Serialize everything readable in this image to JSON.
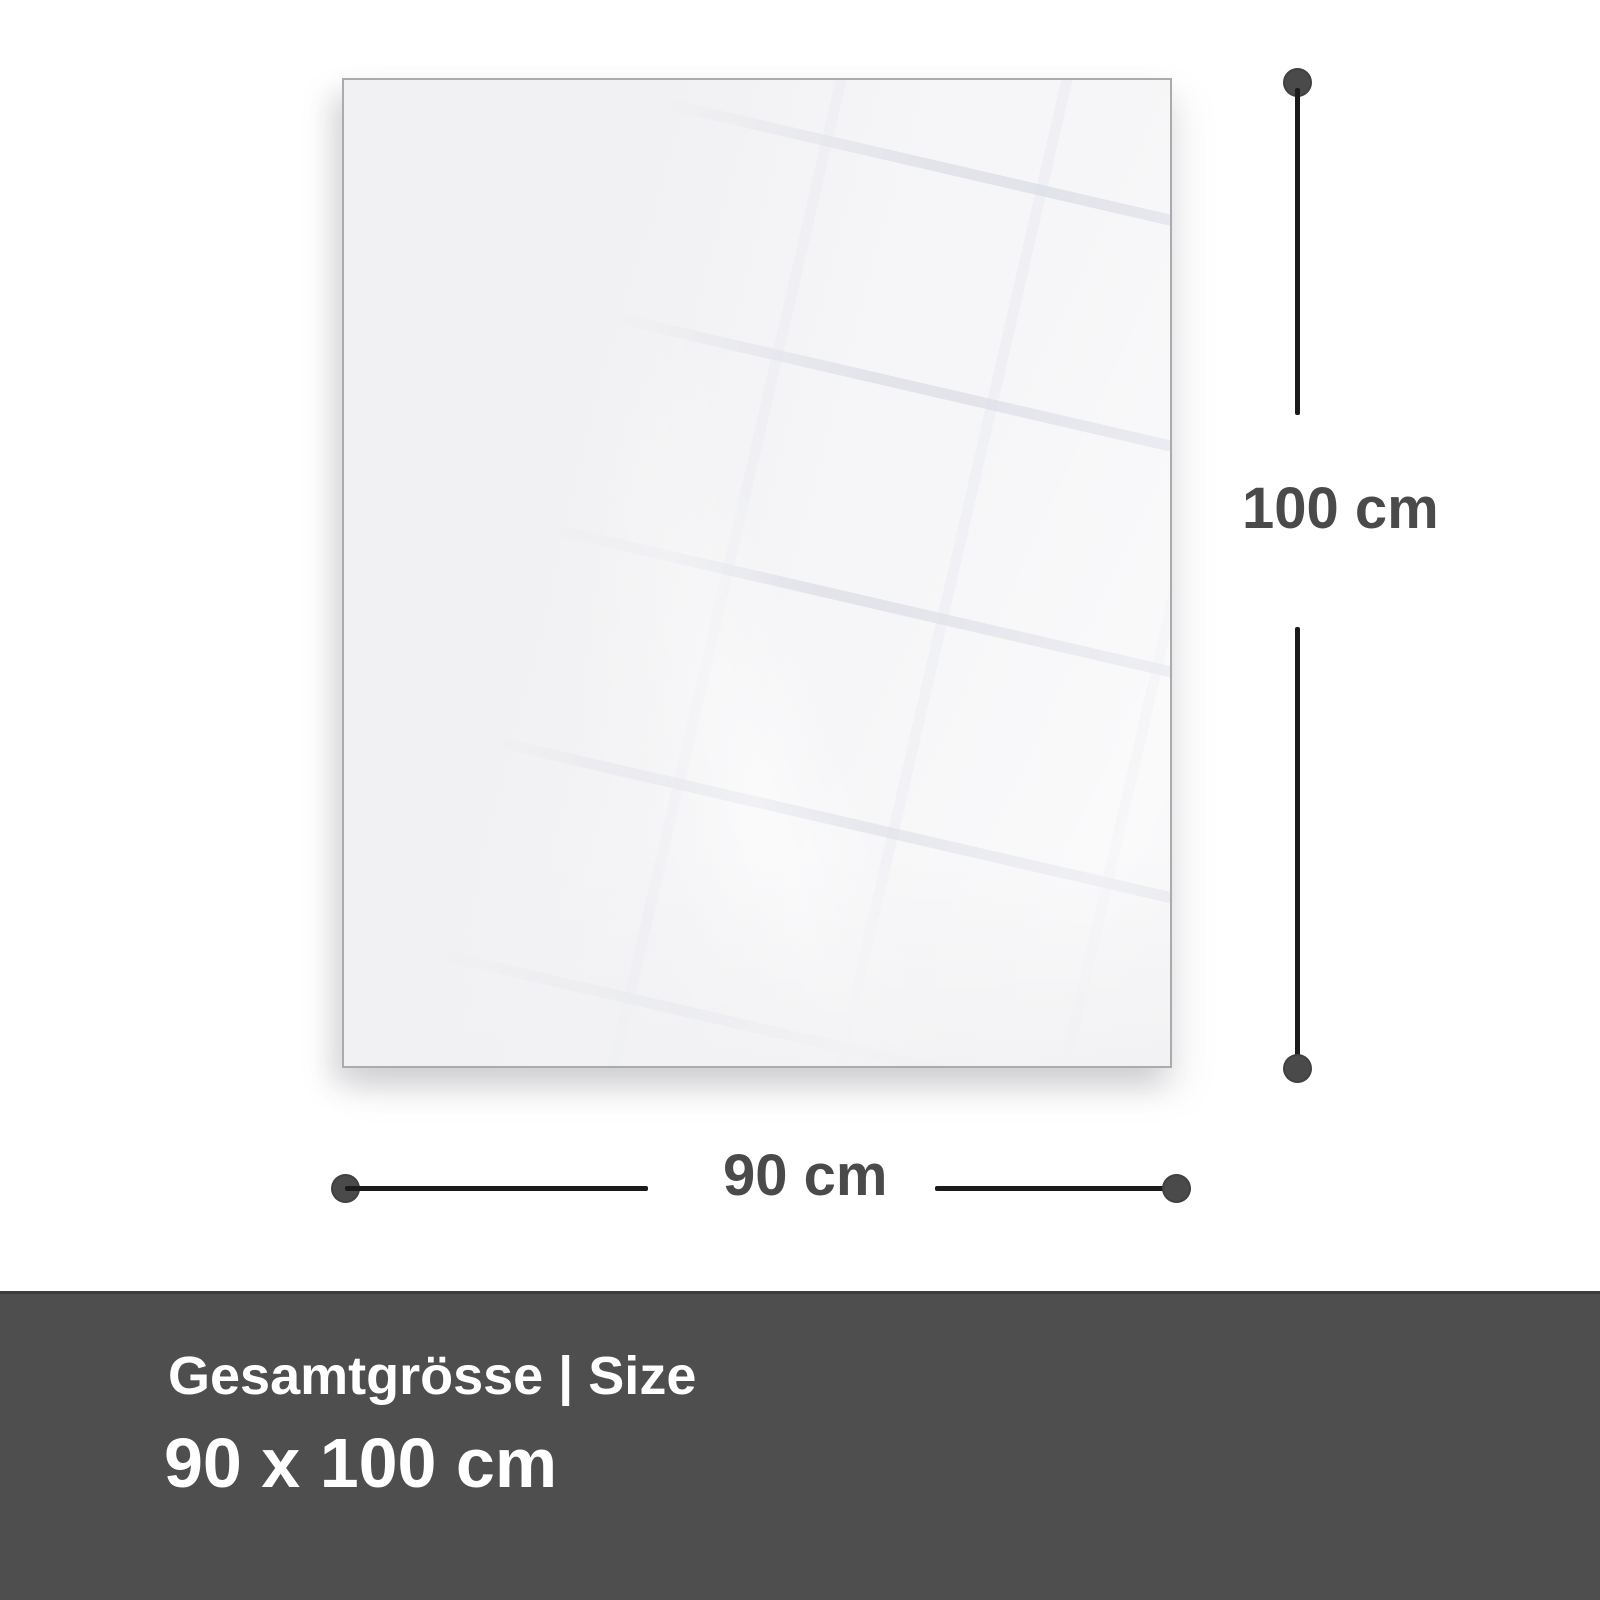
{
  "diagram": {
    "dimensions": {
      "height_label": "100 cm",
      "width_label": "90 cm"
    }
  },
  "footer": {
    "title": "Gesamtgrösse | Size",
    "size_value": "90 x 100 cm"
  },
  "colors": {
    "dimension_text": "#4a4a4a",
    "dimension_line": "#1b1b1b",
    "dimension_dot": "#4a4a4a",
    "footer_background": "#4e4e4e",
    "footer_border": "#3c3c3c",
    "footer_text": "#ffffff",
    "panel_fill": "#f1f1f3",
    "panel_border": "#ababab",
    "page_background": "#ffffff"
  }
}
